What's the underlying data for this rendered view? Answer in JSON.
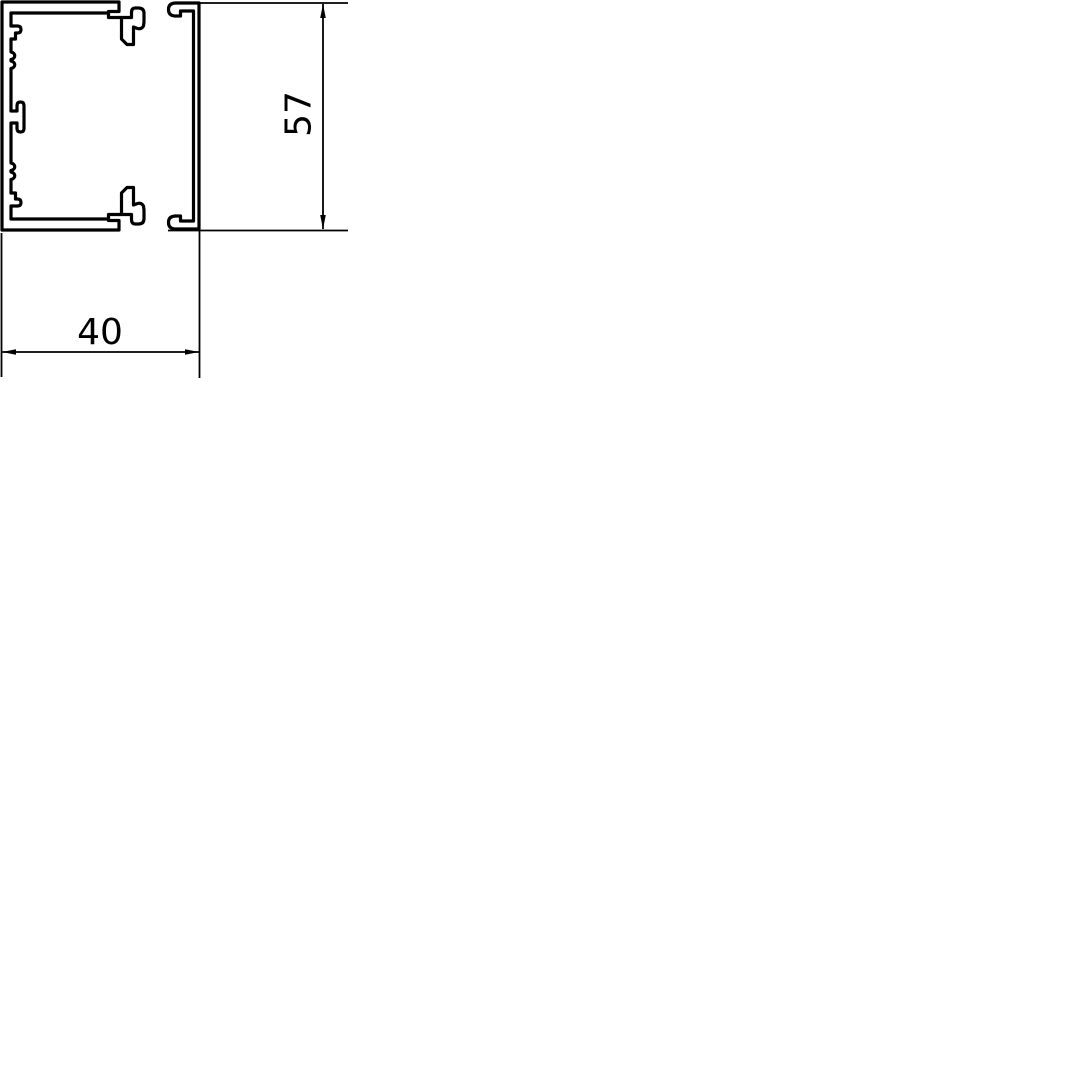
{
  "page": {
    "background": "#ffffff",
    "line_color": "#000000"
  },
  "drawing": {
    "type": "technical-cross-section",
    "subject": "cable-trunking-profile",
    "views": [
      {
        "name": "base-profile-cross-section"
      },
      {
        "name": "cover-profile-cross-section"
      }
    ],
    "dimensions": [
      {
        "label": "40",
        "orientation": "horizontal"
      },
      {
        "label": "57",
        "orientation": "vertical"
      }
    ]
  },
  "geometry": {
    "base": "M2,2 H119 V11.5 H108.5 V13 H11 V26 H17.5 Q21,26 21,29.5 Q21,33 17.5,33 H15.5 V39 H11 V52 c5,1 5,6.5 0,7.5 v1.5 c5,1 5,6.5 0,7.5 V111 H17 V105.5 Q17,102 20.5,102 Q24,102 24,105.5 V128.5 Q24,132 20.5,132 Q17,132 17,128.5 V123 H11 V163 c5,1 5,6.5 0,7.5 v1.5 c5,1 5,6.5 0,7.5 V193 H15.5 V199 H17.5 Q21,199 21,202.5 Q21,206 17.5,206 H11 V219 H108.5 V220.5 H119 V230 H2 Z",
    "latch_top": "M108.5,13 V17.5 H121.5 V39 L127,44.5 H133.5 V27 L137.5,28.5 Q141.5,29.5 143.5,26 L144,22 V13.5 Q144,8 138.5,8 H135.5 Q131.5,8 131.5,12.5 V17.5 H108.5 Z",
    "latch_bottom": "M108.5,219 V214.5 H121.5 V193 L127,187.5 H133.5 V205 L137.5,203.5 Q141.5,202.5 143.5,206 L144,210 V218.5 Q144,224 138.5,224 H135.5 Q131.5,224 131.5,219.5 V214.5 H108.5 Z",
    "cover": "M199,3 H176 Q168.5,3 168.5,9.5 Q168.5,16 176,16 H180.5 V11 H193.5 V221 H180.5 V216 H176 Q168.5,216 168.5,222.5 Q168.5,229 176,229 H199 Z",
    "ext_57_top": "M200,3 H348",
    "ext_57_bottom": "M168,230.5 H348",
    "dim_57_line": "M323,4 V229",
    "arrow_57_up": "M323,4 L320.2,18 L325.8,18 Z",
    "arrow_57_down": "M323,229 L320.2,215 L325.8,215 Z",
    "ext_40_left": "M1.5,233 V377",
    "ext_40_right": "M199.5,229 V378",
    "dim_40_line": "M2,352 H199",
    "arrow_40_left": "M2,352 L16,349.2 L16,354.8 Z",
    "arrow_40_right": "M199,352 L185,349.2 L185,354.8 Z"
  }
}
